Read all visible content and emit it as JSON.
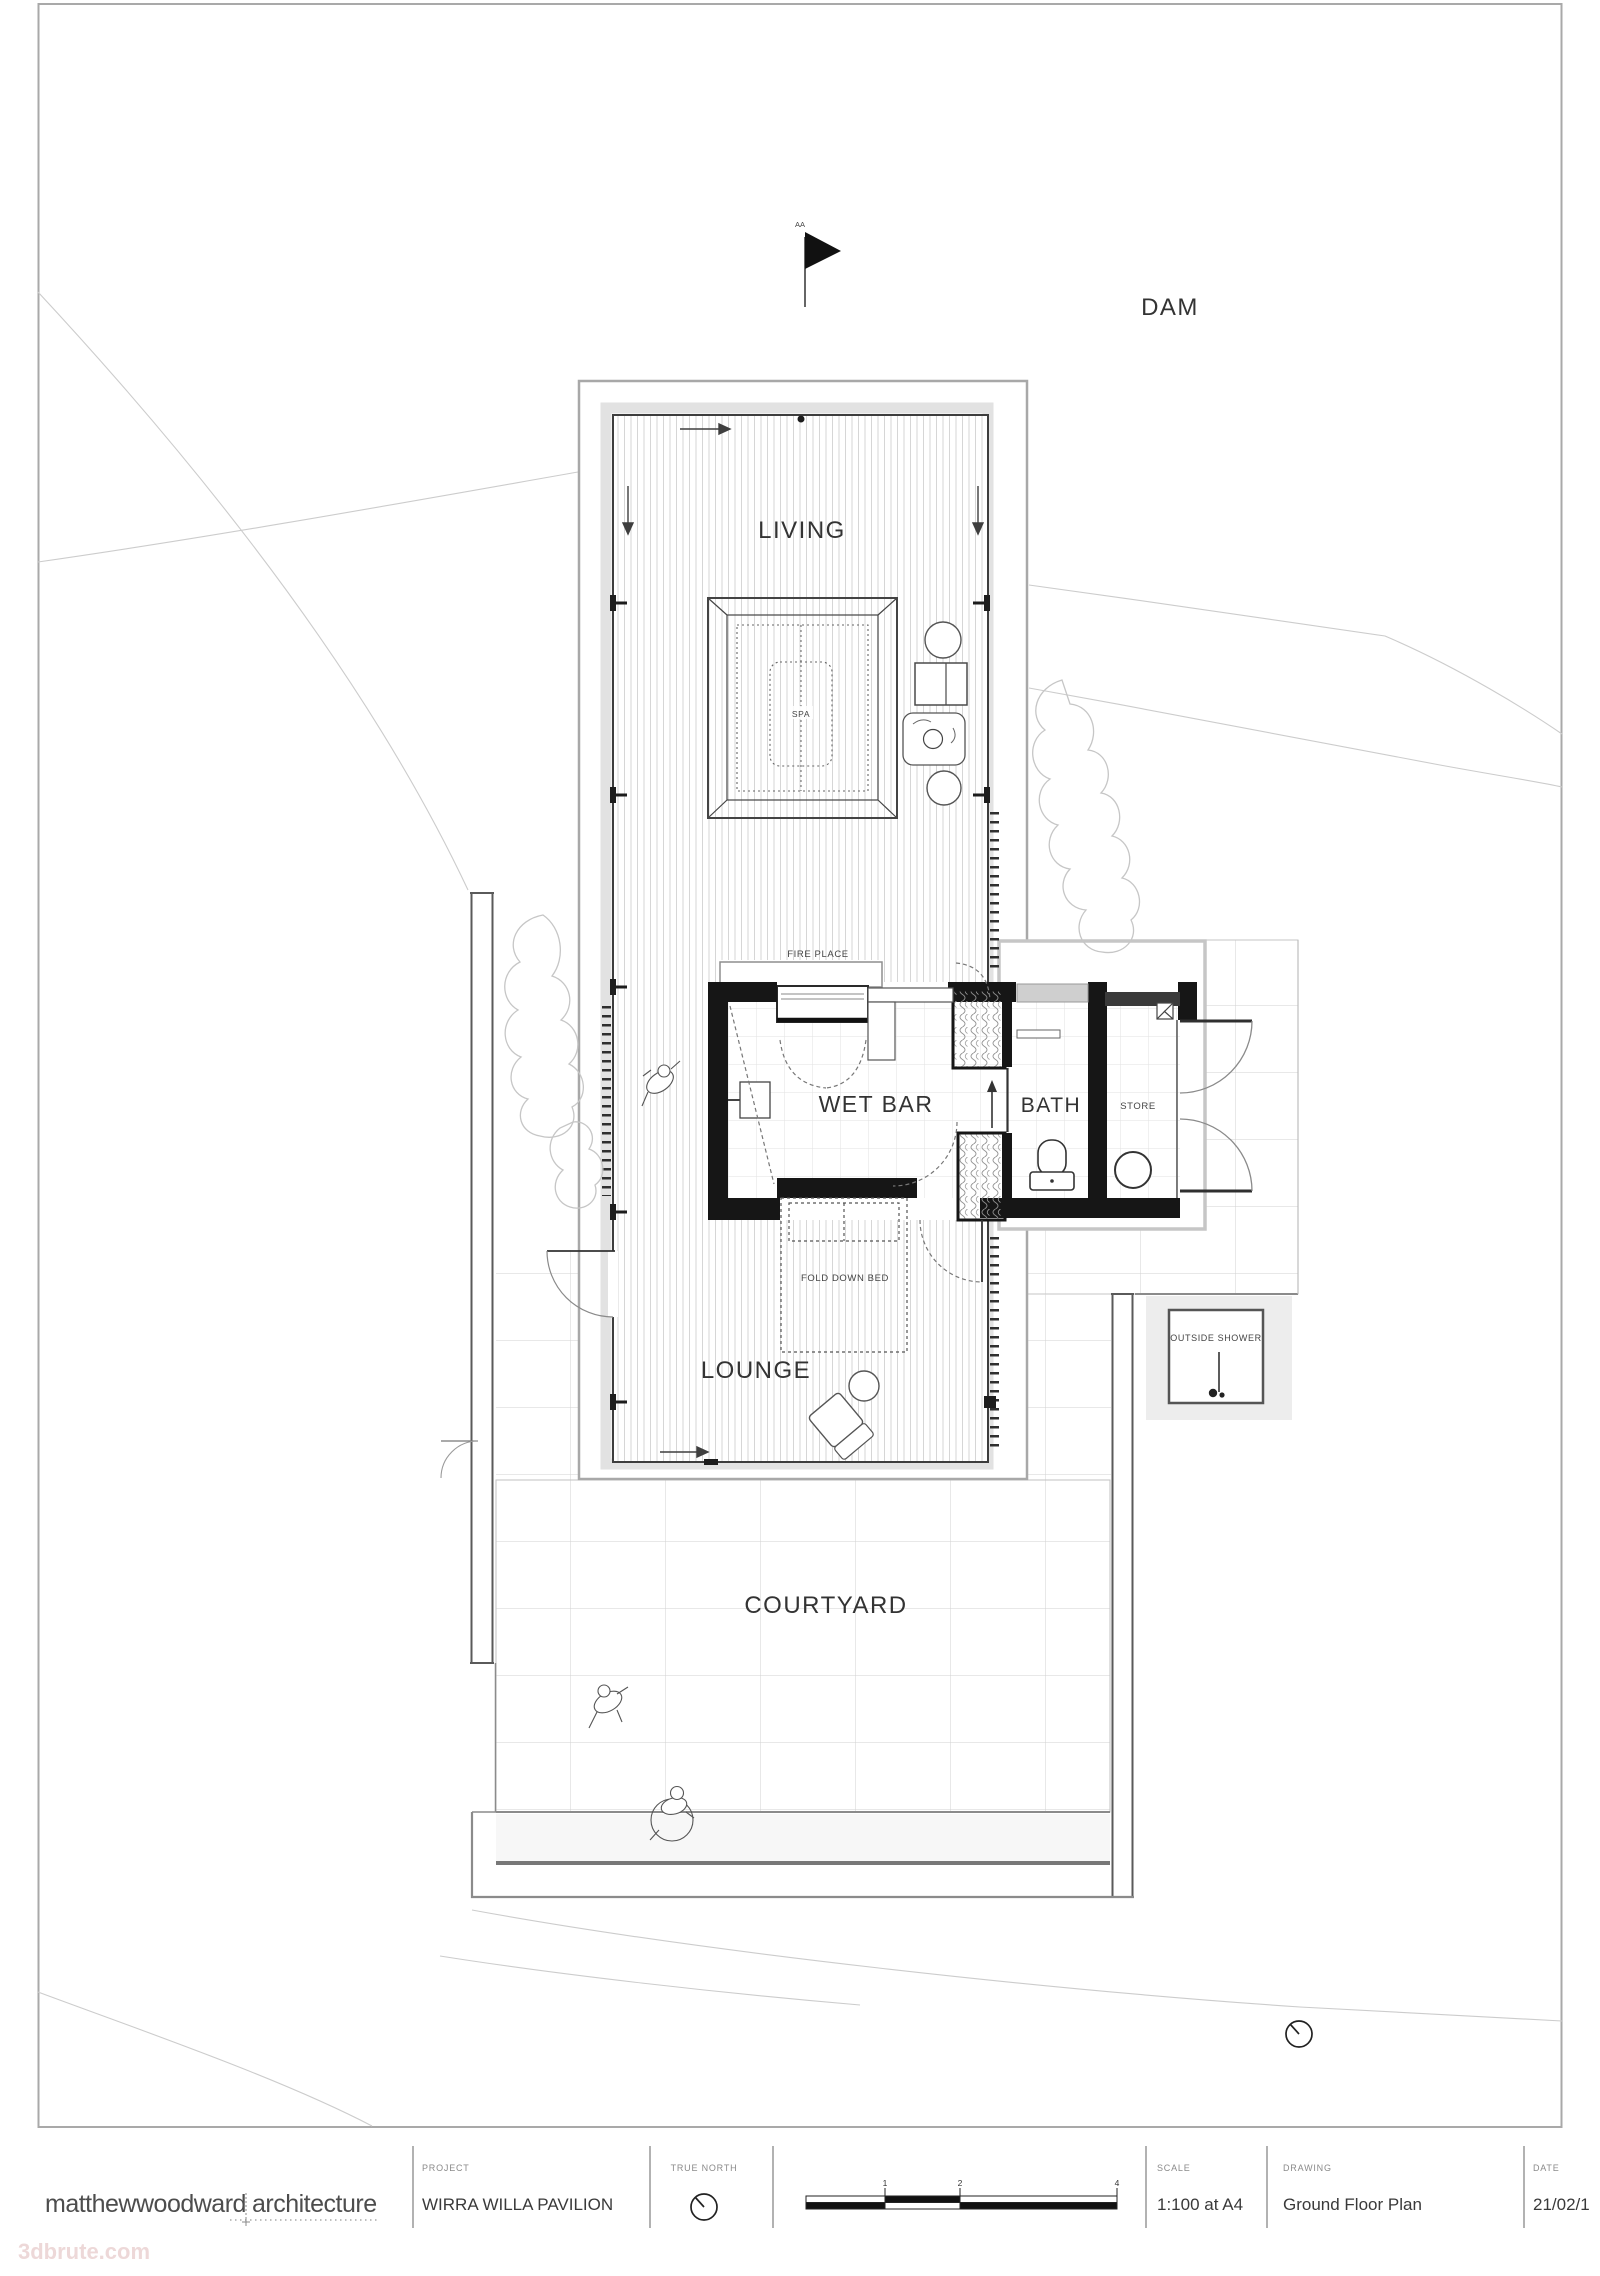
{
  "labels": {
    "dam": "DAM",
    "section_marker": "AA",
    "living": "LIVING",
    "spa": "SPA",
    "fire_place": "FIRE PLACE",
    "wet_bar": "WET BAR",
    "bath": "BATH",
    "store": "STORE",
    "fold_down_bed": "FOLD DOWN BED",
    "lounge": "LOUNGE",
    "outside_shower": "OUTSIDE SHOWER",
    "courtyard": "COURTYARD"
  },
  "title_block": {
    "firm": {
      "name_left": "matthewwoodward",
      "name_right": "architecture"
    },
    "project": {
      "label": "PROJECT",
      "value": "WIRRA WILLA PAVILION"
    },
    "true_north": {
      "label": "TRUE NORTH"
    },
    "scale": {
      "label": "SCALE",
      "value": "1:100 at A4"
    },
    "drawing": {
      "label": "DRAWING",
      "value": "Ground Floor Plan"
    },
    "date": {
      "label": "DATE",
      "value": "21/02/1"
    },
    "scale_bar": {
      "ticks": [
        "1",
        "2",
        "4"
      ]
    }
  },
  "watermark": "3dbrute.com",
  "colors": {
    "wall": "#161616",
    "deck_hatch": "#d6d6d6",
    "grid": "#d2d2d2",
    "overhang_gray": "#b5b5b5",
    "watermark_pink": "#ead2d2"
  }
}
